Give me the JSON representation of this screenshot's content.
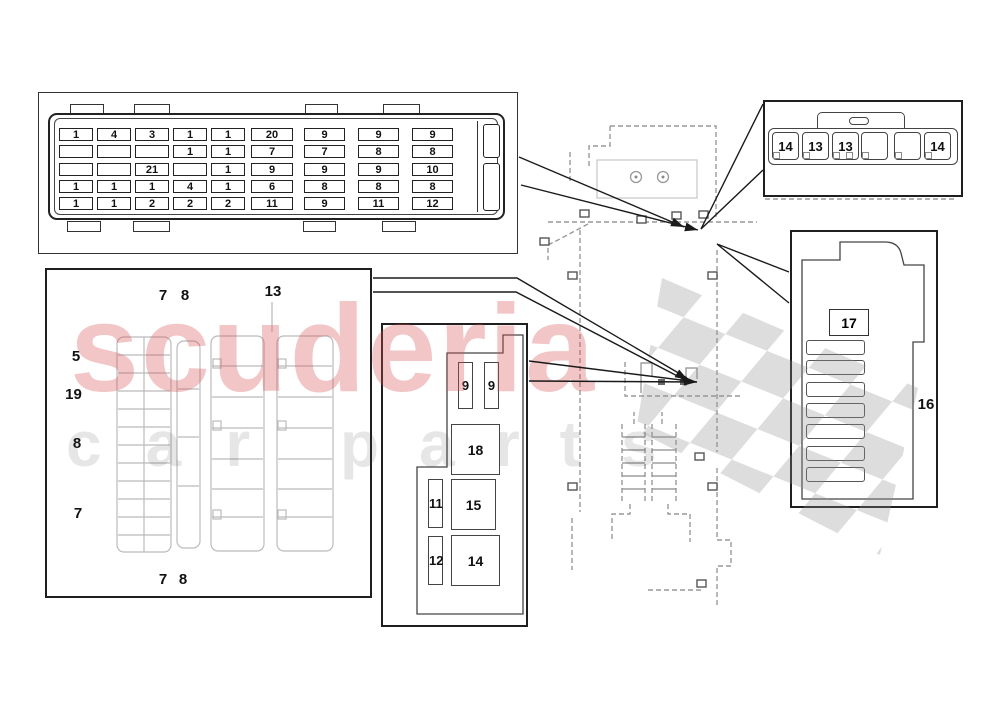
{
  "watermark": {
    "word": "scuderia",
    "sub_left": "car",
    "sub_right": "parts",
    "red": "#d95353"
  },
  "main_fusebox": {
    "rows": [
      [
        "1",
        "4",
        "3",
        "1",
        "1",
        "20",
        "9",
        "9",
        "9"
      ],
      [
        "",
        "",
        "",
        "1",
        "1",
        "7",
        "7",
        "8",
        "8"
      ],
      [
        "",
        "",
        "21",
        "",
        "1",
        "9",
        "9",
        "9",
        "10"
      ],
      [
        "1",
        "1",
        "1",
        "4",
        "1",
        "6",
        "8",
        "8",
        "8"
      ],
      [
        "1",
        "1",
        "2",
        "2",
        "2",
        "11",
        "9",
        "11",
        "12"
      ]
    ]
  },
  "aux_box": {
    "slots": [
      "14",
      "13",
      "13",
      "",
      "",
      "14"
    ]
  },
  "side_box": {
    "relay": "17",
    "callout": "16"
  },
  "relay_box": {
    "fuse_top_1": "9",
    "fuse_top_2": "9",
    "relay_big_1": "18",
    "fuse_mid": "11",
    "relay_big_2": "15",
    "fuse_bot": "12",
    "relay_big_3": "14"
  },
  "floor_panel": {
    "top": [
      "7",
      "8",
      "13"
    ],
    "left": [
      "5",
      "19",
      "8",
      "7"
    ],
    "bottom": [
      "7",
      "8"
    ]
  }
}
